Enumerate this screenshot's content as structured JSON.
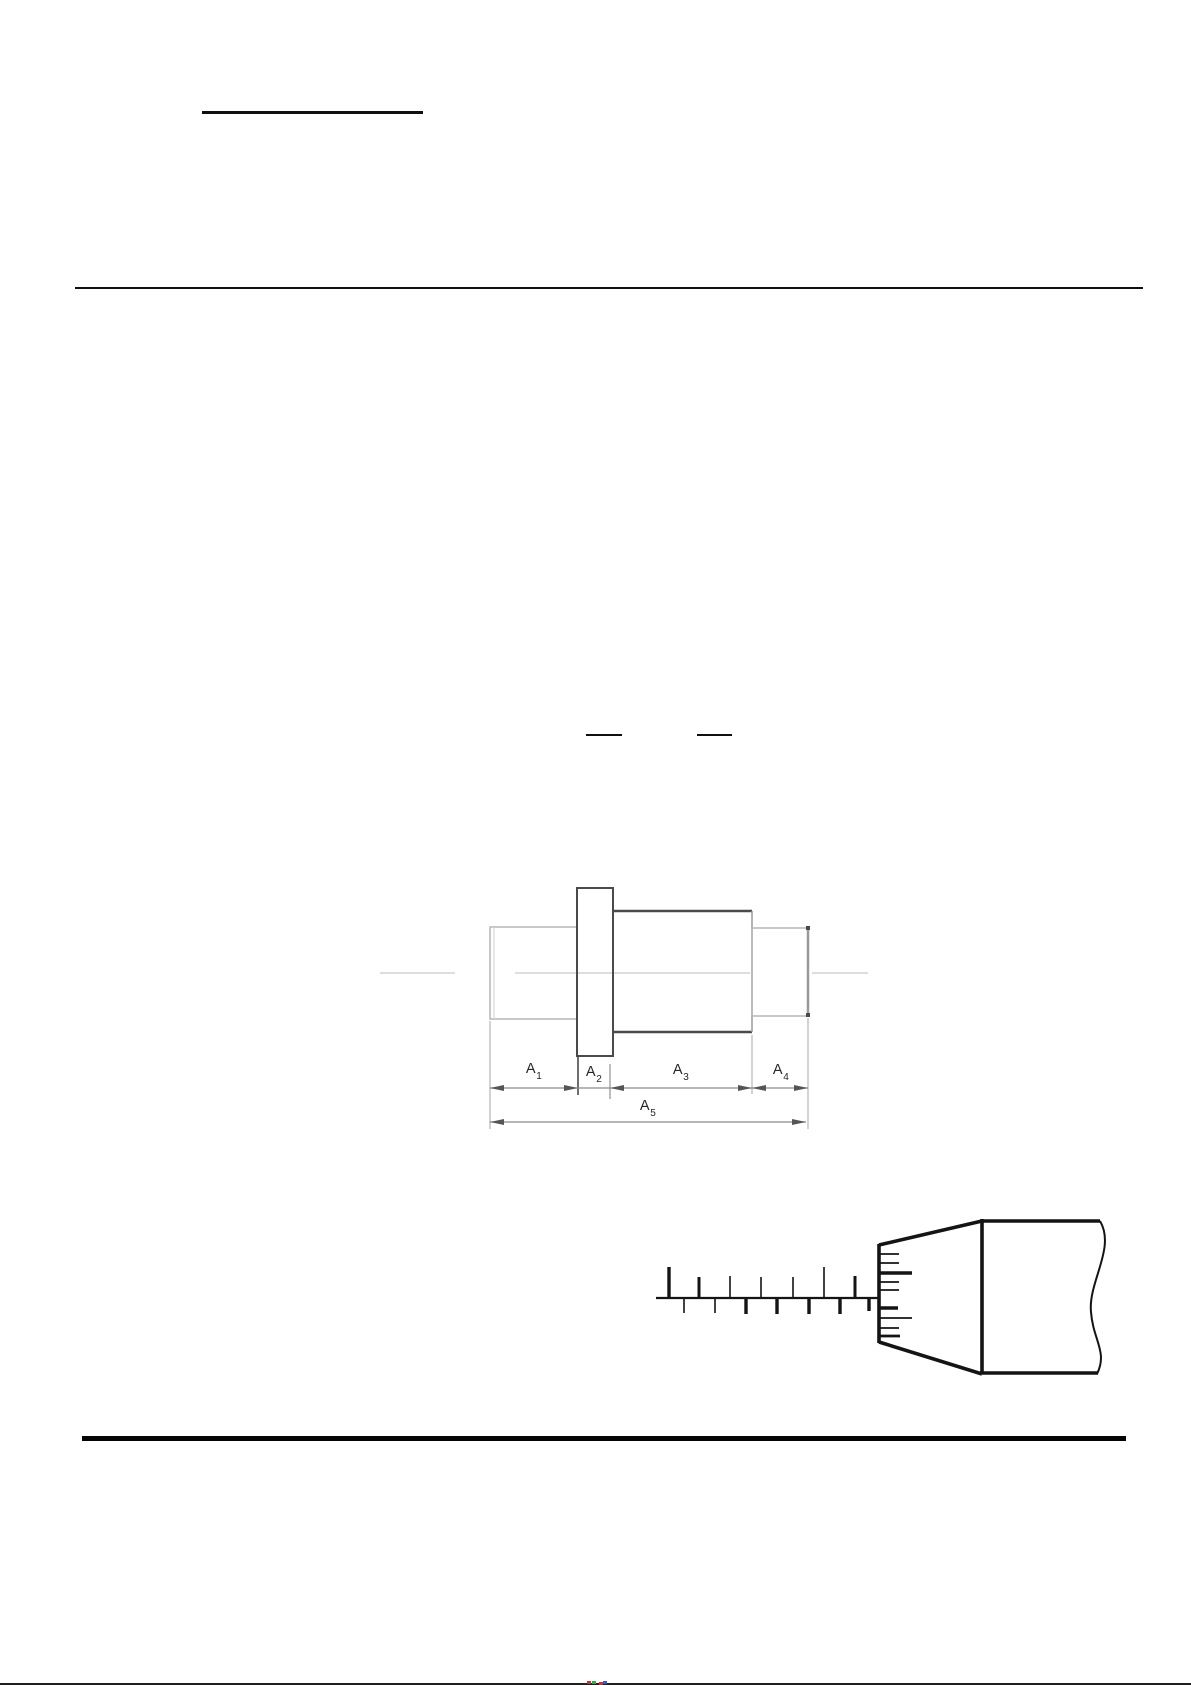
{
  "page": {
    "background": "#ffffff"
  },
  "shaft_figure": {
    "labels": [
      {
        "base": "A",
        "sub": "1"
      },
      {
        "base": "A",
        "sub": "2"
      },
      {
        "base": "A",
        "sub": "3"
      },
      {
        "base": "A",
        "sub": "4"
      },
      {
        "base": "A",
        "sub": "5"
      }
    ]
  },
  "colors": {
    "page-bg": "#ffffff",
    "ink": "#141414",
    "rule": "#101010",
    "line-dark": "#4a4a4a",
    "line-mid": "#9a9a9a",
    "line-light": "#b5b5b5",
    "centerline": "#d2d2d2",
    "dim": "#8a8a8a",
    "arrow": "#555555",
    "label": "#262626",
    "edge-strip": "#1f1f1f",
    "artifact-red": "#b43a3a",
    "artifact-green": "#3f9d55",
    "artifact-blue": "#4156b8"
  }
}
